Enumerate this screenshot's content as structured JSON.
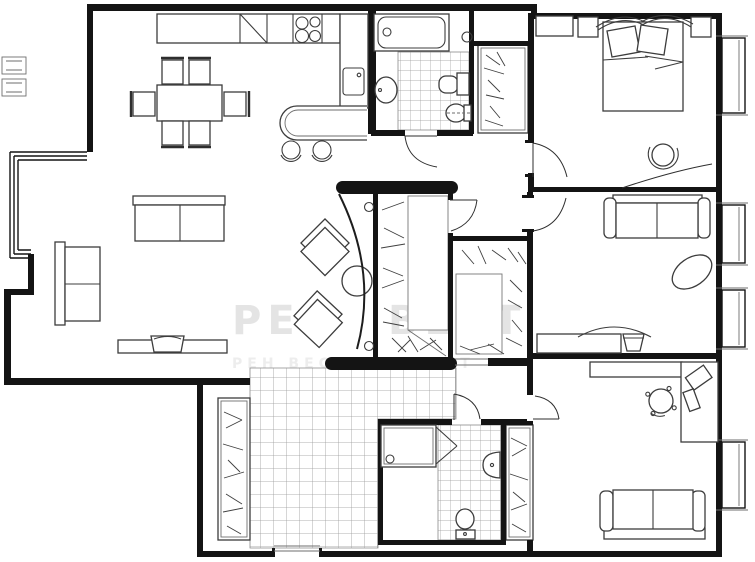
{
  "watermark": {
    "line1_left": "РЕН",
    "line1_right": "ВЕСТ",
    "line2": "РЕН ВЕСТ РЕН ВЕСТ"
  },
  "palette": {
    "background": "#ffffff",
    "wall": "#141414",
    "furniture_stroke": "#3c3c3c",
    "tile_grid": "#999999",
    "watermark": "#e4e4e4"
  }
}
